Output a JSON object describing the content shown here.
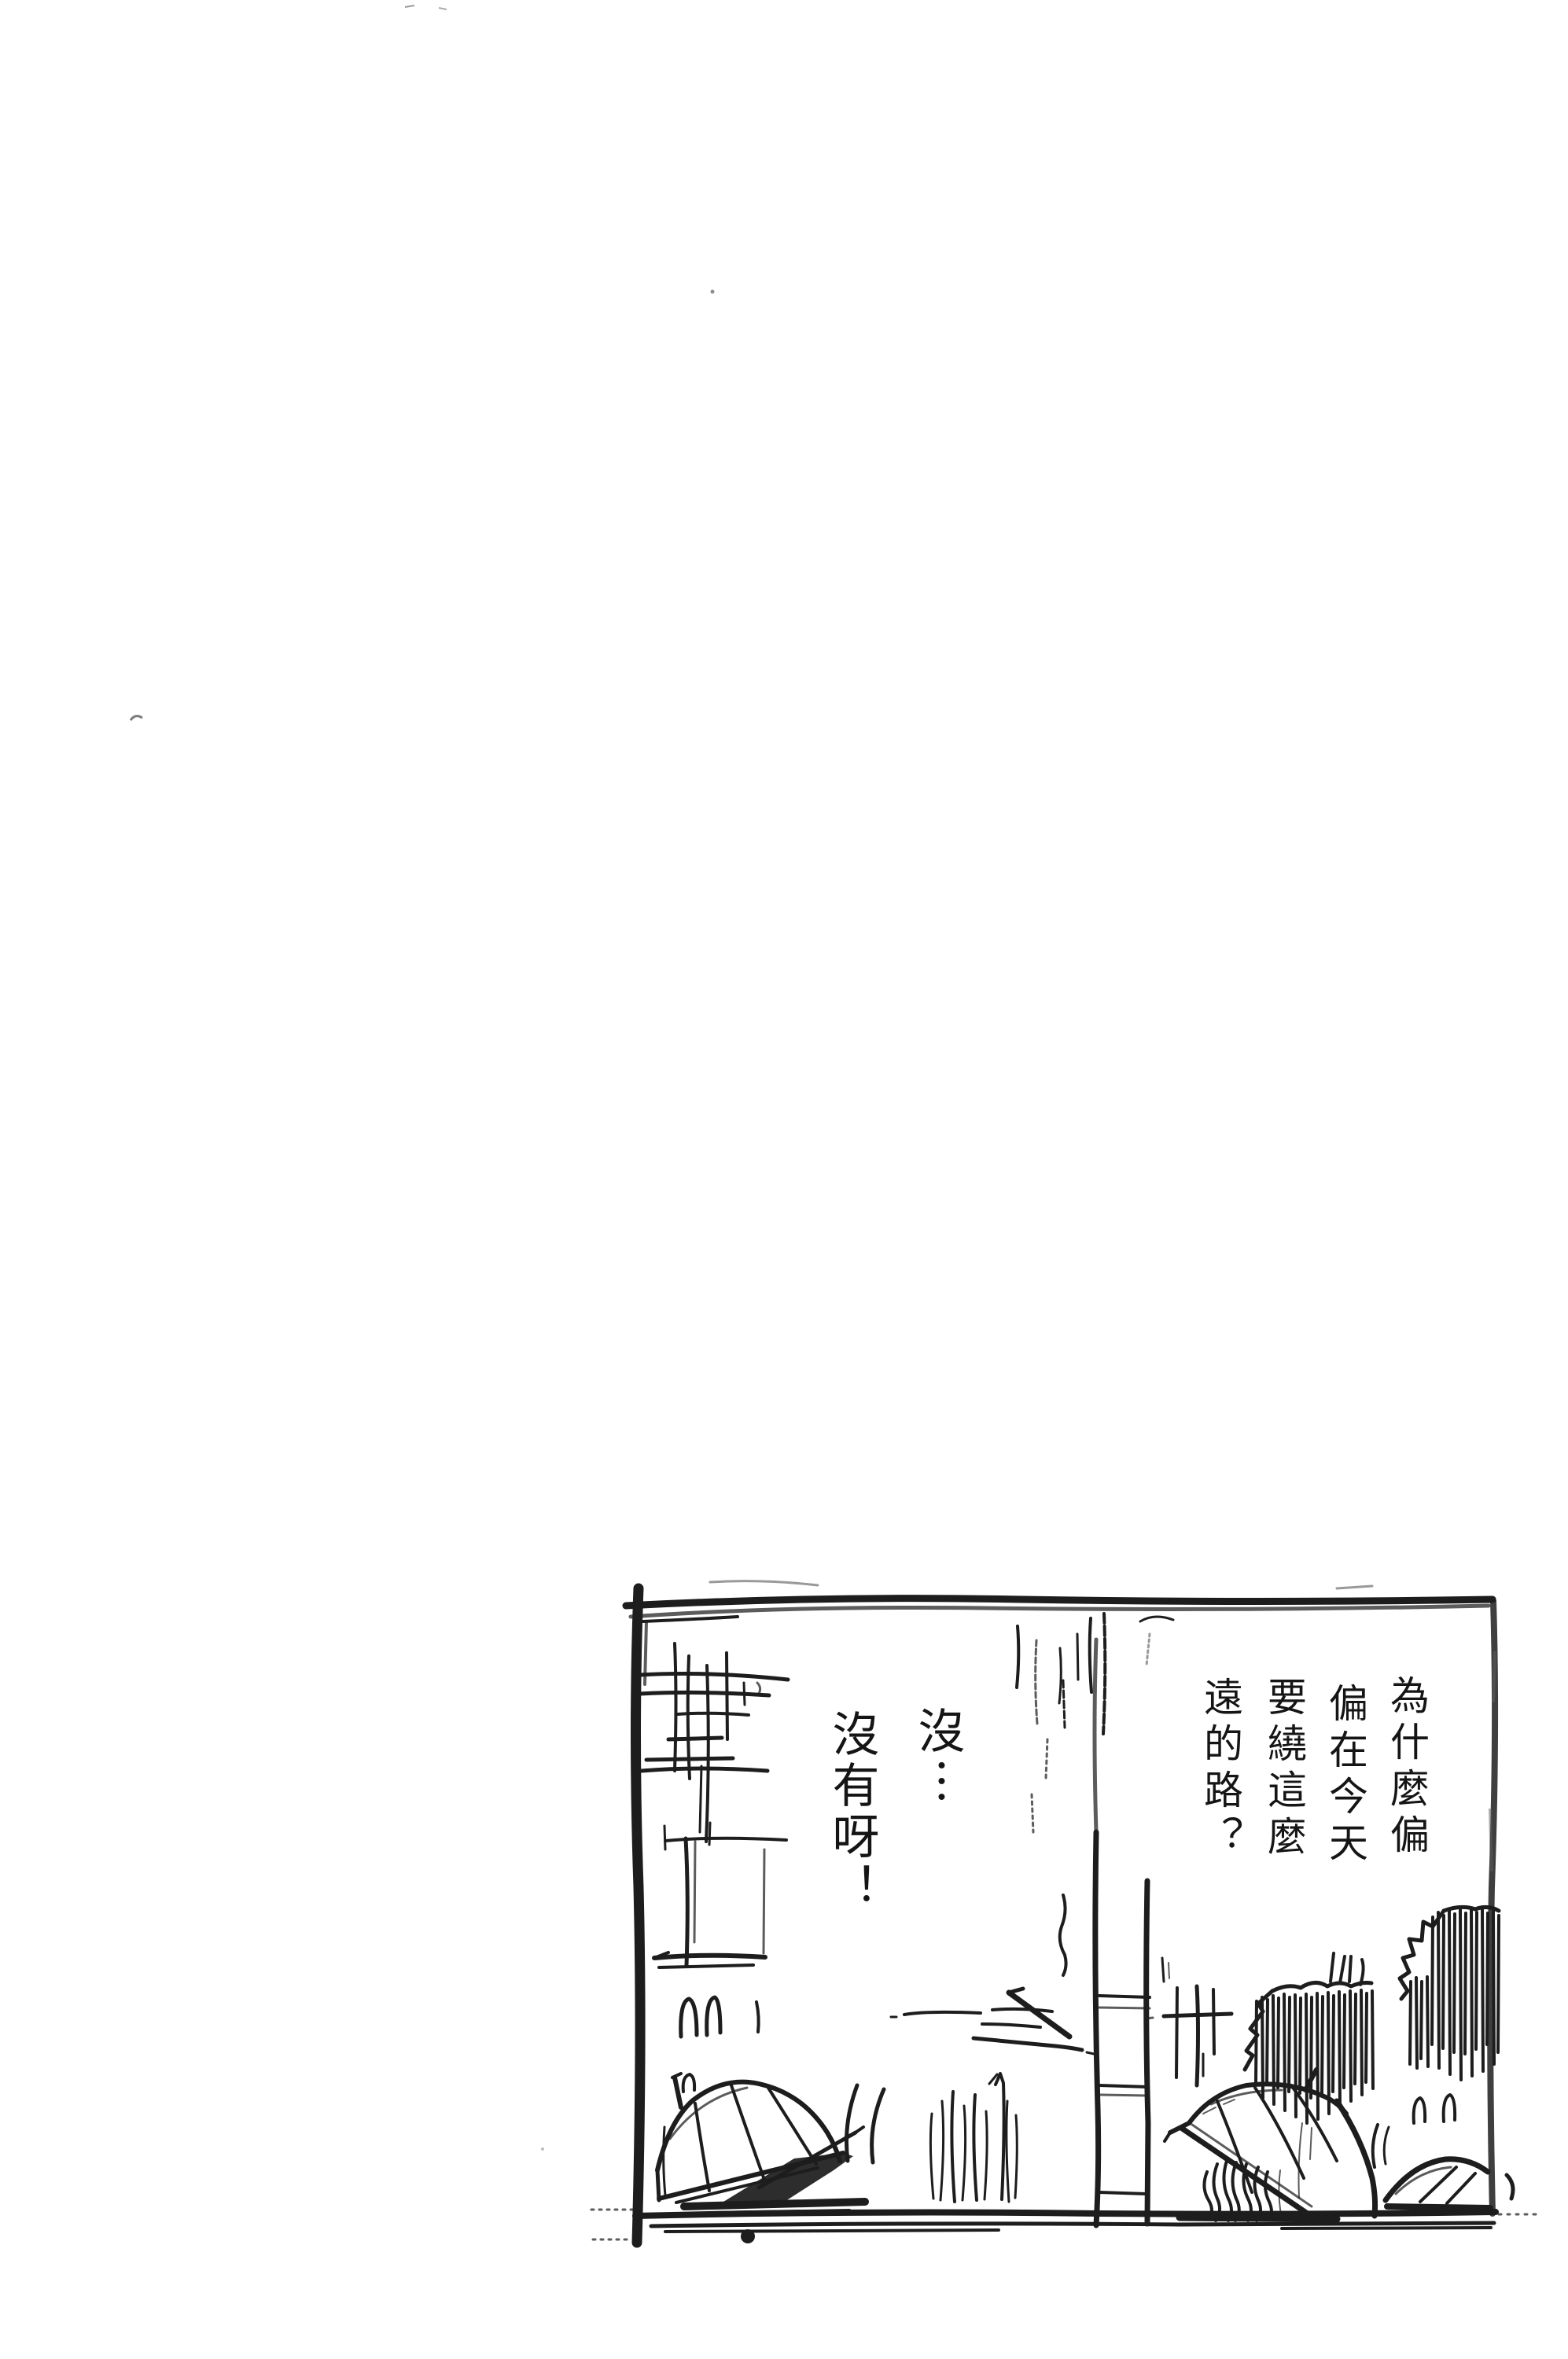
{
  "page": {
    "background": "#ffffff",
    "ink_color": "#1d1d1d",
    "text_color": "#151515"
  },
  "panel": {
    "description": "Rough pencil-sketch manga panel: rainy street scene with open umbrellas resting on the ground, a person with curly hair crouched under the center umbrella, a tall utility pole, building scribbles on the left and hatched bushes on the right",
    "elements": [
      "panel-border",
      "building-sketch",
      "rain-streaks",
      "utility-pole",
      "speed-lines",
      "grass-tufts",
      "rain-arcs",
      "bush-center",
      "bush-right",
      "crossarm-pole",
      "umbrella-left",
      "umbrella-center-with-person",
      "umbrella-right-partial",
      "ground"
    ]
  },
  "dialogue": {
    "right_balloon": {
      "reading": "vertical, columns right to left",
      "columns": [
        "為什麼偏",
        "偏在今天",
        "要繞這麼",
        "遠的路？"
      ]
    },
    "left_balloon": {
      "reading": "vertical, columns right to left",
      "columns": [
        "沒︙",
        "沒有呀！"
      ]
    }
  }
}
